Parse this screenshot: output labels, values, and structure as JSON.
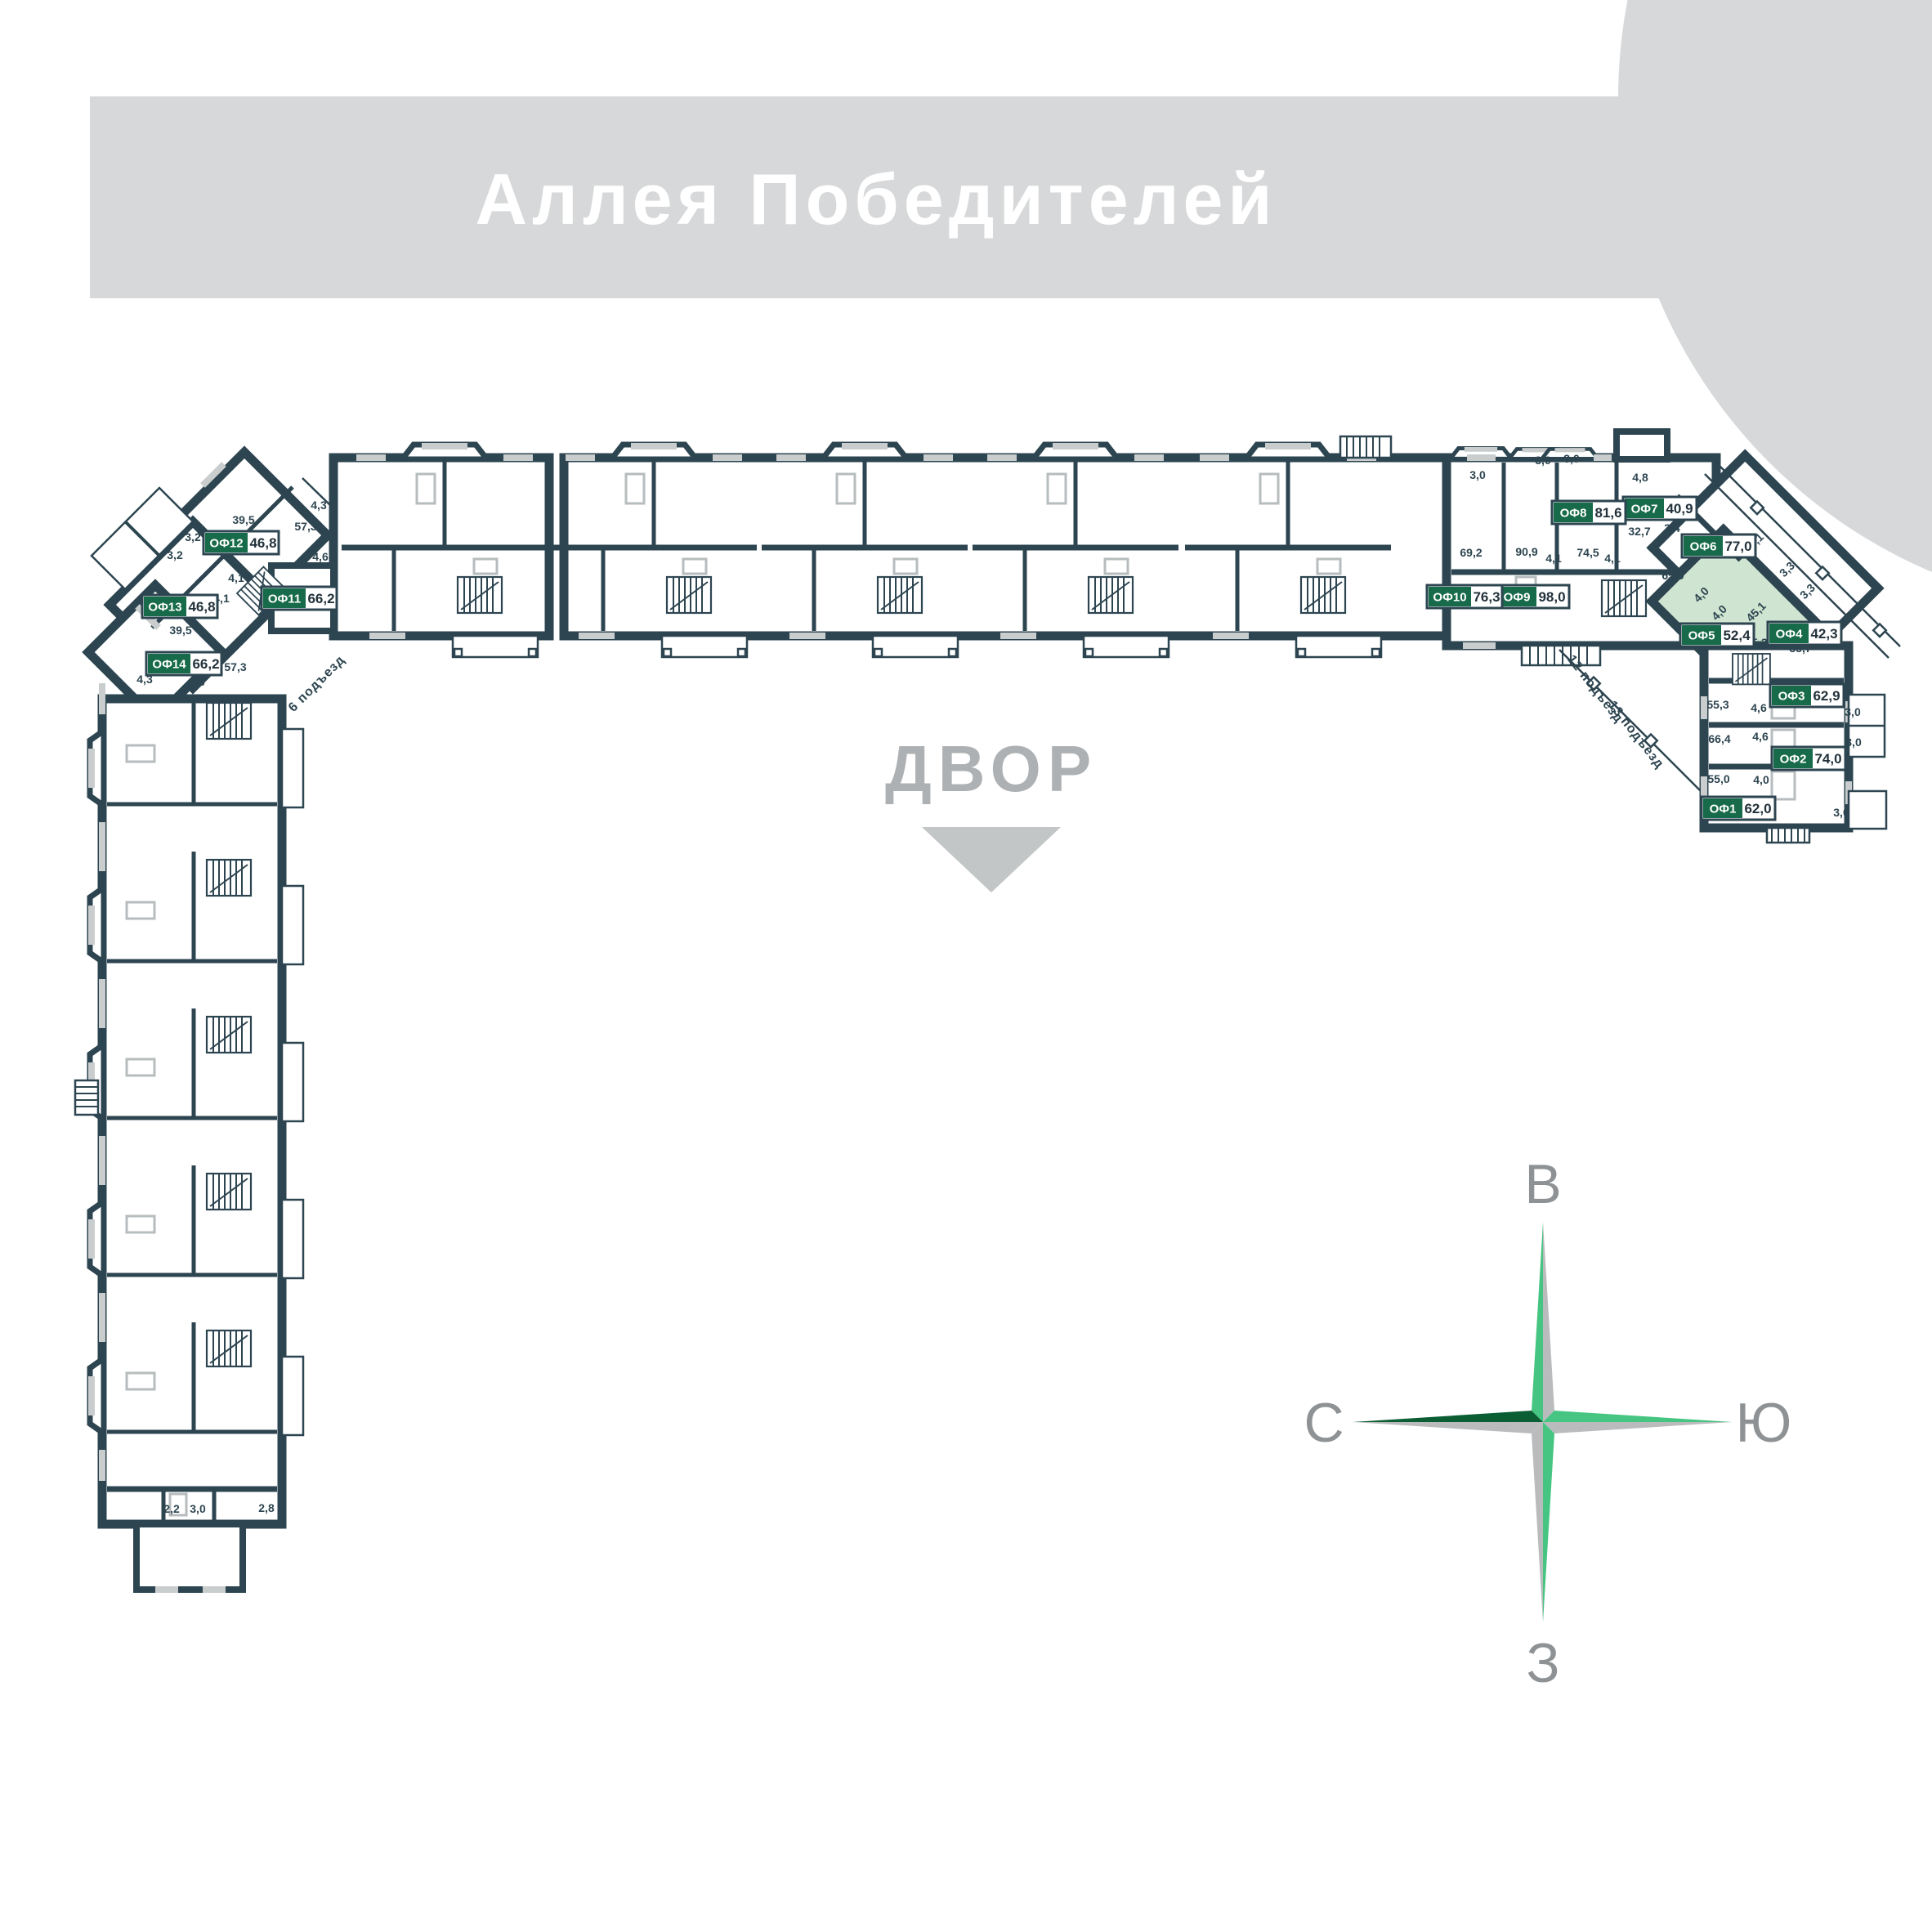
{
  "banner": {
    "title": "Аллея Победителей"
  },
  "courtyard": {
    "label": "ДВОР"
  },
  "compass": {
    "top": "В",
    "left": "С",
    "right": "Ю",
    "bottom": "З"
  },
  "entrances": {
    "e6": "6 подъезд",
    "e12": "12 подъезд",
    "e13": "13 подъезд"
  },
  "offices": [
    {
      "id": "ОФ1",
      "area": "62,0",
      "highlighted": false
    },
    {
      "id": "ОФ2",
      "area": "74,0",
      "highlighted": false
    },
    {
      "id": "ОФ3",
      "area": "62,9",
      "highlighted": false
    },
    {
      "id": "ОФ4",
      "area": "42,3",
      "highlighted": false
    },
    {
      "id": "ОФ5",
      "area": "52,4",
      "highlighted": true
    },
    {
      "id": "ОФ6",
      "area": "77,0",
      "highlighted": false
    },
    {
      "id": "ОФ7",
      "area": "40,9",
      "highlighted": false
    },
    {
      "id": "ОФ8",
      "area": "81,6",
      "highlighted": false
    },
    {
      "id": "ОФ9",
      "area": "98,0",
      "highlighted": false
    },
    {
      "id": "ОФ10",
      "area": "76,3",
      "highlighted": false
    },
    {
      "id": "ОФ11",
      "area": "66,2",
      "highlighted": false
    },
    {
      "id": "ОФ12",
      "area": "46,8",
      "highlighted": false
    },
    {
      "id": "ОФ13",
      "area": "46,8",
      "highlighted": false
    },
    {
      "id": "ОФ14",
      "area": "66,2",
      "highlighted": false
    }
  ],
  "dims": [
    {
      "v": "4,3"
    },
    {
      "v": "57,3"
    },
    {
      "v": "39,5"
    },
    {
      "v": "3,2"
    },
    {
      "v": "3,2"
    },
    {
      "v": "4,6"
    },
    {
      "v": "4,1"
    },
    {
      "v": "4,1"
    },
    {
      "v": "39,5"
    },
    {
      "v": "57,3"
    },
    {
      "v": "4,6"
    },
    {
      "v": "4,3"
    },
    {
      "v": "3,0"
    },
    {
      "v": "3,0"
    },
    {
      "v": "3,0"
    },
    {
      "v": "4,8"
    },
    {
      "v": "69,2"
    },
    {
      "v": "90,9"
    },
    {
      "v": "74,5"
    },
    {
      "v": "4,1"
    },
    {
      "v": "4,1"
    },
    {
      "v": "32,7"
    },
    {
      "v": "3,4"
    },
    {
      "v": "65,9"
    },
    {
      "v": "7,1"
    },
    {
      "v": "3,3"
    },
    {
      "v": "3,3"
    },
    {
      "v": "45,1"
    },
    {
      "v": "4,0"
    },
    {
      "v": "4,0"
    },
    {
      "v": "5,3"
    },
    {
      "v": "33,7"
    },
    {
      "v": "55,3"
    },
    {
      "v": "4,6"
    },
    {
      "v": "3,0"
    },
    {
      "v": "66,4"
    },
    {
      "v": "4,6"
    },
    {
      "v": "3,0"
    },
    {
      "v": "55,0"
    },
    {
      "v": "4,0"
    },
    {
      "v": "3,0"
    },
    {
      "v": "2,2"
    },
    {
      "v": "3,0"
    },
    {
      "v": "2,8"
    }
  ],
  "colors": {
    "wall": "#2d4550",
    "banner_gray": "#d6d8d9",
    "badge_green": "#176a4a",
    "highlight_green": "#cfe4d1",
    "label_gray": "#aeb1b3",
    "compass_green": "#45c581",
    "compass_dark_green": "#0b5e33",
    "compass_gray": "#b9bbbc"
  }
}
